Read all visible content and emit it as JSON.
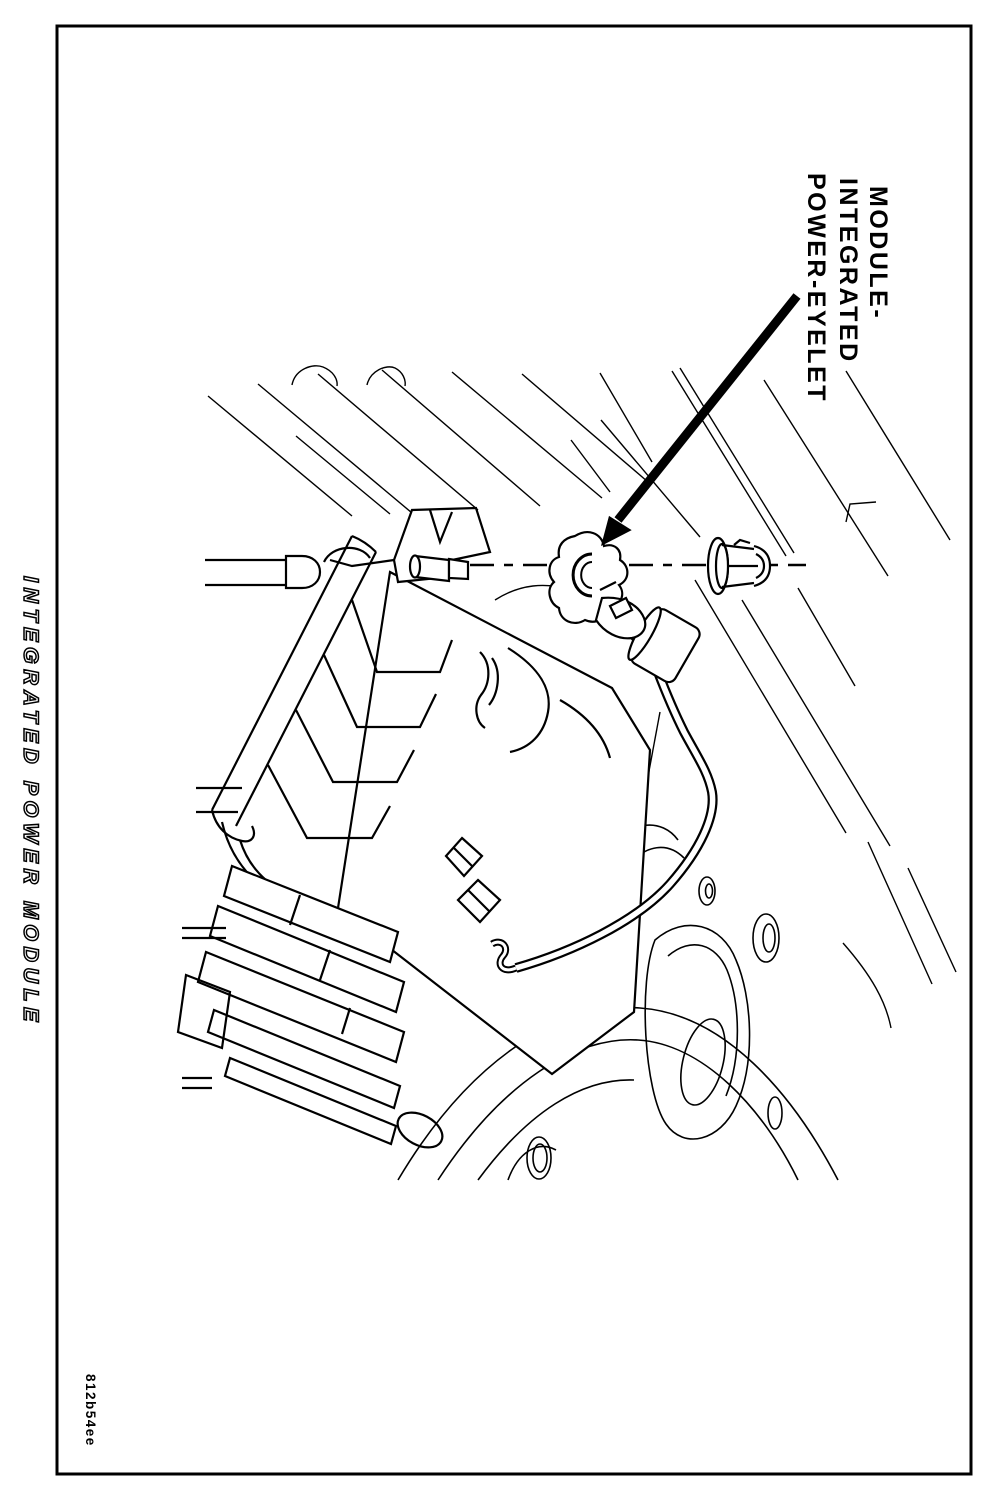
{
  "page": {
    "title": "INTEGRATED POWER MODULE",
    "figure_code": "812b54ee",
    "paper_color": "#ffffff",
    "ink_color": "#000000",
    "orientation": "landscape page rotated 90 degrees clockwise"
  },
  "callout": {
    "line1": "MODULE-",
    "line2": "INTEGRATED",
    "line3": "POWER-EYELET",
    "full_label": "MODULE-INTEGRATED POWER-EYELET"
  },
  "illustration": {
    "description": "Black and white engine-compartment line drawing showing the integrated power module with finned housing and connectors, a battery cable with power eyelet terminal aligned on a mounting stud center line, and a hex flange nut; a heavy arrow points from the callout label to the eyelet."
  }
}
